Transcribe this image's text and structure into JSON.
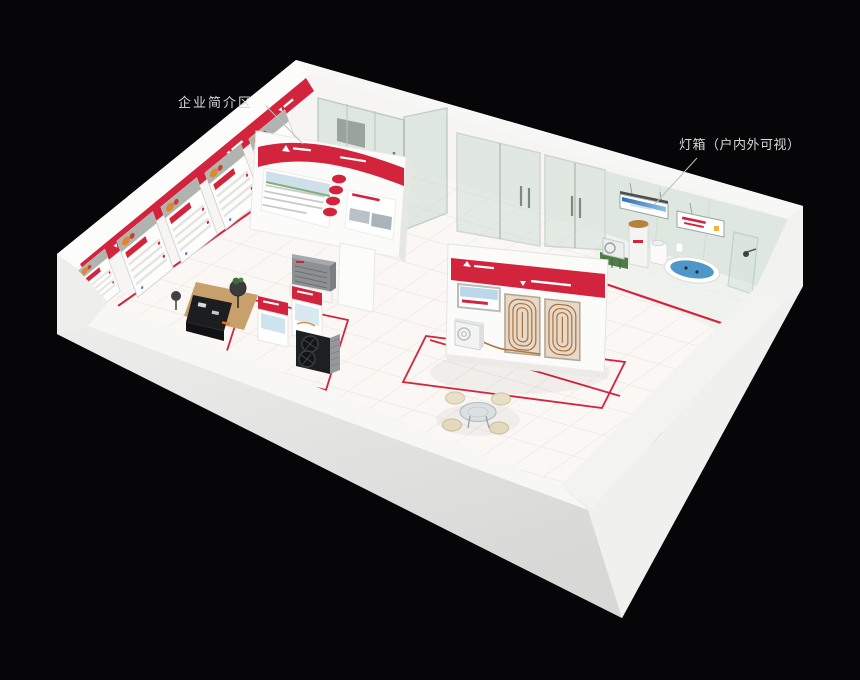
{
  "annotations": {
    "company_intro": {
      "label": "企业简介区"
    },
    "light_box": {
      "label": "灯箱（户内外可视）"
    }
  },
  "colors": {
    "background": "#060608",
    "accent_red": "#d3243e",
    "wall_white": "#f6f5f3",
    "outer_gray": "#e7e7e5",
    "floor": "#faf7f4",
    "glass_green": "#cddcd3",
    "bath_wall": "#dfe8e0",
    "bath_water": "#4e97c8",
    "tank_lid": "#b5813c",
    "wood": "#c8a06b",
    "fan_dark": "#1d1f22",
    "coil_copper": "#a9713f",
    "label_text": "#d6d6d6"
  }
}
